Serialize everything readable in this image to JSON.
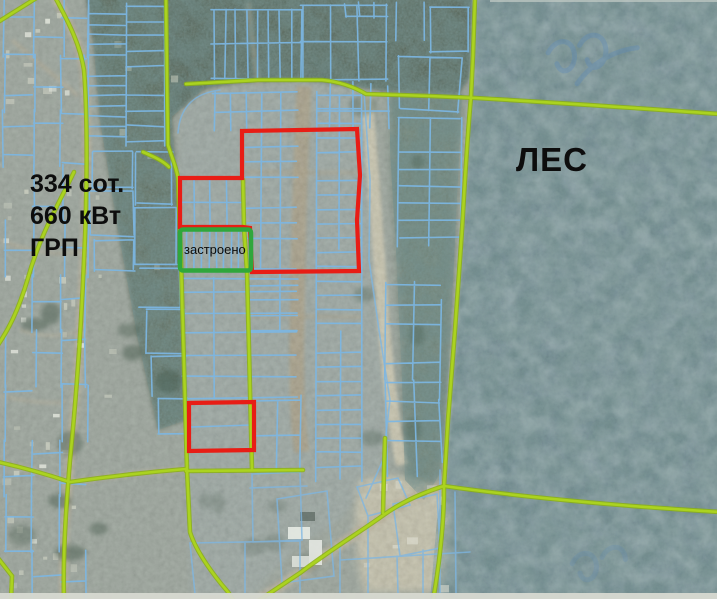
{
  "window": {
    "width": 717,
    "height": 599,
    "kind": "satellite cadastral map viewer"
  },
  "map": {
    "labels": {
      "area": "334 сот.",
      "power": "660 кВт",
      "grp": "ГРП",
      "forest": "ЛЕС",
      "built": "застроено"
    },
    "colors": {
      "parcel_line": "#7cb6e3",
      "road_line": "#abd31f",
      "road_edge": "#8cb112",
      "highlight_red": "#e81d15",
      "highlight_green": "#2fa73c",
      "label_text": "#0d0d0d",
      "watermark": "#5688c0",
      "field_base": "#97a197",
      "forest_dark": "#48594a",
      "forest_blue": "#66828b",
      "scrub": "#5b7365",
      "sand": "#cdc7ad",
      "dirt": "#b7ab90",
      "bottom_bar": "#d7d9d1"
    }
  }
}
